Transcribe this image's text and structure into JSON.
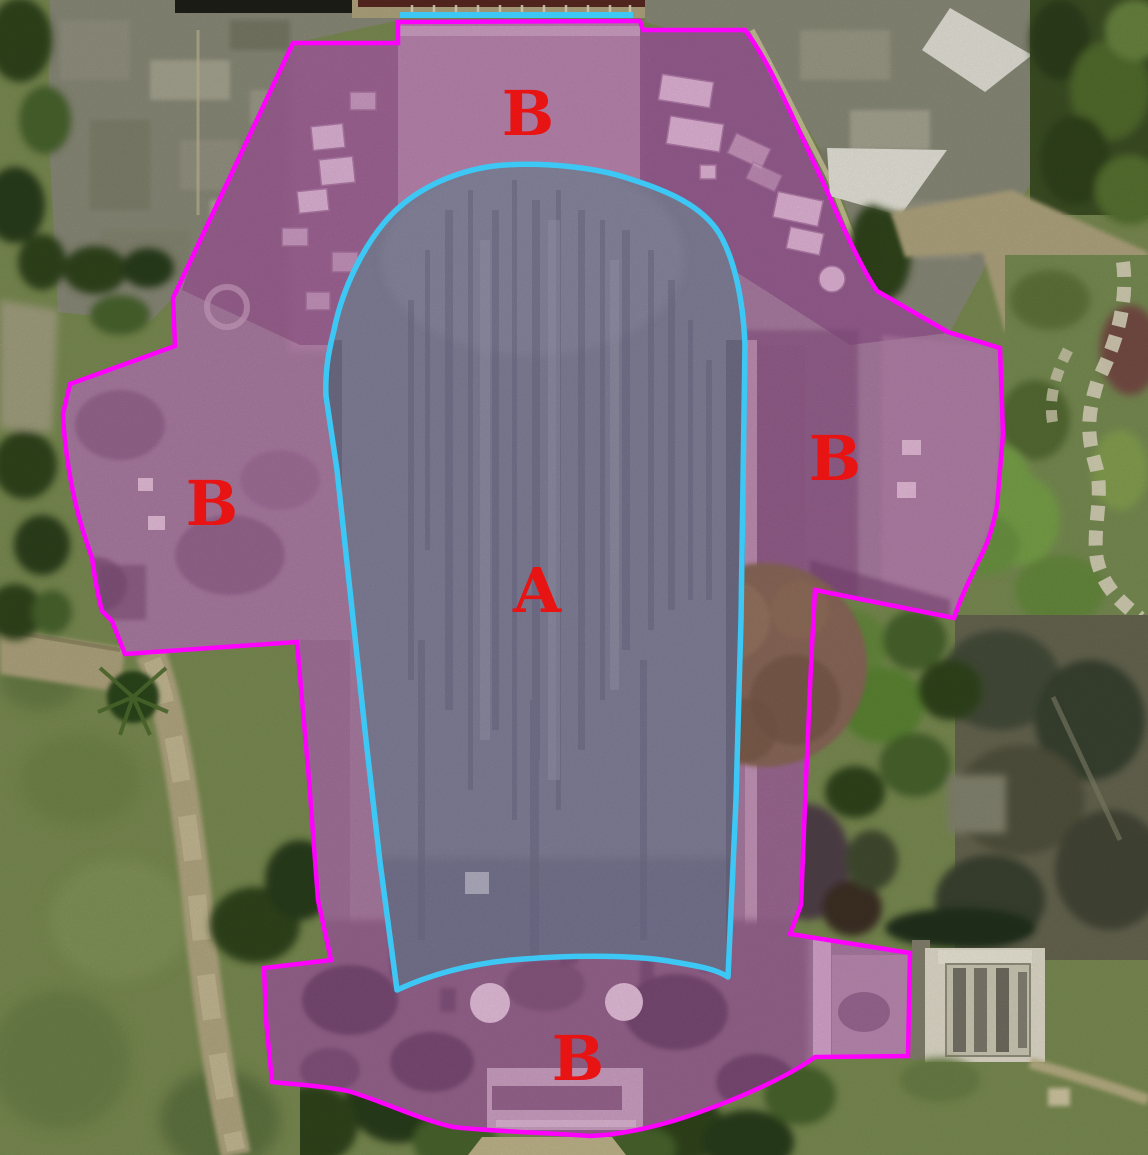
{
  "image_kind": "aerial-roof-zone-annotation",
  "colors": {
    "region_a_outline": "#3dc7f4",
    "region_b_outline": "#ff00ff",
    "label_red": "#e81313"
  },
  "regions": {
    "a": {
      "letter": "A"
    },
    "b": {
      "letter": "B"
    }
  },
  "labels": [
    {
      "id": "a-center",
      "text": "A"
    },
    {
      "id": "b-top",
      "text": "B"
    },
    {
      "id": "b-left",
      "text": "B"
    },
    {
      "id": "b-right",
      "text": "B"
    },
    {
      "id": "b-bottom",
      "text": "B"
    }
  ]
}
